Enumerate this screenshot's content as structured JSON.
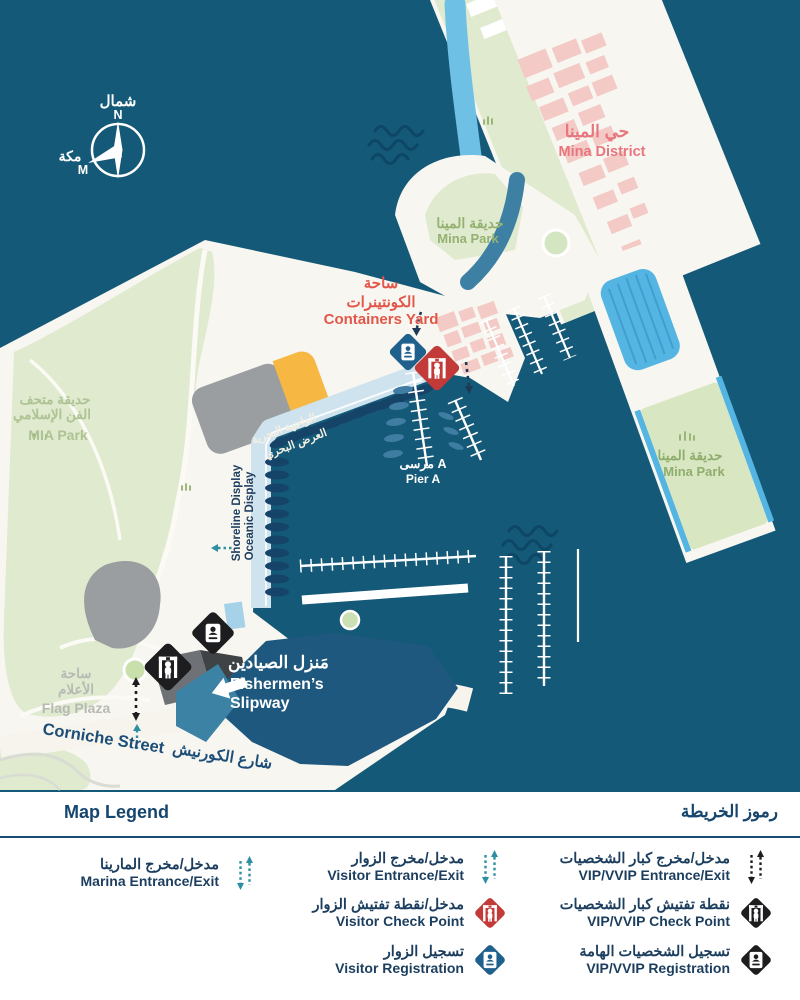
{
  "colors": {
    "water": "#145978",
    "wave": "#0e4765",
    "land": "#f8f6f0",
    "park_green": "#dfeacf",
    "park_green_right": "#d8e6c2",
    "pink_buildings": "#f3cac5",
    "light_blue": "#6fc0e5",
    "striped_blue": "#55b5e2",
    "boardwalk": "#cfe3ee",
    "boat_navy": "#164368",
    "slipway_blue": "#1f587e",
    "channel_blue": "#3e7fa4",
    "orange": "#f6b843",
    "gray_building": "#9b9ea1",
    "navy_text": "#1c3e5e",
    "teal": "#2f8fa2",
    "red": "#c23b38",
    "blue": "#20608c",
    "black": "#1d1d1f"
  },
  "map": {
    "compass": {
      "north_ar": "شمال",
      "north_letter": "N",
      "makkah_ar": "مكة",
      "makkah_letter": "M"
    },
    "labels": {
      "mina_district": {
        "ar": "حي المينا",
        "en": "Mina District"
      },
      "mina_park_top": {
        "ar": "حديقة المينا",
        "en": "Mina Park"
      },
      "containers_yard": {
        "ar_line1": "ساحة",
        "ar_line2": "الكونتينرات",
        "en": "Containers Yard"
      },
      "mia_park": {
        "ar_line1": "حديقة متحف",
        "ar_line2": "الفن الإسلامي",
        "en": "MIA Park"
      },
      "pier_a": {
        "ar": "مرسى A",
        "en": "Pier A"
      },
      "waterfront": {
        "ar_line1": "الواجهة البحرية",
        "ar_line2": "العرض البحري",
        "en_line1": "Shoreline Display",
        "en_line2": "Oceanic Display"
      },
      "fishermens_slipway": {
        "ar": "مَنزل الصيادين",
        "en_line1": "Fishermen’s",
        "en_line2": "Slipway"
      },
      "flag_plaza": {
        "ar_line1": "ساحة",
        "ar_line2": "الأعلام",
        "en": "Flag Plaza"
      },
      "corniche_street": {
        "en": "Corniche Street",
        "ar": "شارع الكورنيش"
      },
      "mina_park_right": {
        "ar": "حديقة المينا",
        "en": "Mina Park"
      }
    }
  },
  "legend": {
    "title_en": "Map Legend",
    "title_ar": "رموز الخريطة",
    "items": [
      {
        "id": "marina-entrance-exit",
        "ar": "مدخل/مخرج المارينا",
        "en": "Marina Entrance/Exit",
        "icon": "dashed-route-icon",
        "color": "#2f8fa2"
      },
      {
        "id": "visitor-entrance-exit",
        "ar": "مدخل/مخرج الزوار",
        "en": "Visitor Entrance/Exit",
        "icon": "dashed-route-icon",
        "color": "#2f8fa2"
      },
      {
        "id": "visitor-check-point",
        "ar": "مدخل/نقطة تفتيش الزوار",
        "en": "Visitor Check Point",
        "icon": "diamond-checkpoint-icon",
        "color": "#c23b38"
      },
      {
        "id": "visitor-registration",
        "ar": "تسجيل الزوار",
        "en": "Visitor Registration",
        "icon": "diamond-registration-icon",
        "color": "#20608c"
      },
      {
        "id": "vip-entrance-exit",
        "ar": "مدخل/مخرج كبار الشخصيات",
        "en": "VIP/VVIP Entrance/Exit",
        "icon": "dashed-route-icon",
        "color": "#1d1d1f"
      },
      {
        "id": "vip-check-point",
        "ar": "نقطة تفتيش كبار الشخصيات",
        "en": "VIP/VVIP Check Point",
        "icon": "diamond-checkpoint-icon",
        "color": "#1d1d1f"
      },
      {
        "id": "vip-registration",
        "ar": "تسجيل الشخصيات الهامة",
        "en": "VIP/VVIP Registration",
        "icon": "diamond-registration-icon",
        "color": "#1d1d1f"
      }
    ]
  }
}
